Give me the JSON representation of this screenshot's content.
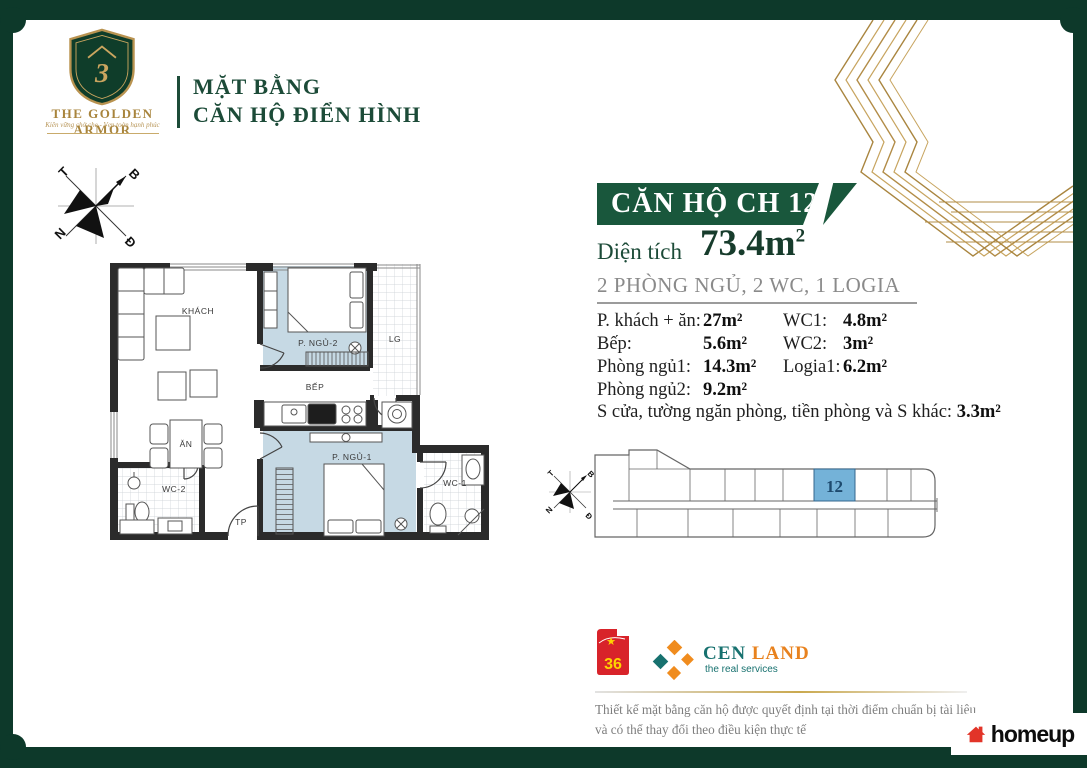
{
  "brand": {
    "name": "THE GOLDEN ARMOR",
    "tagline": "Kiên vững chở che - Vẹn toàn hạnh phúc",
    "title_line1": "MẶT BẰNG",
    "title_line2": "CĂN HỘ ĐIỂN HÌNH"
  },
  "unit": {
    "banner": "CĂN HỘ CH 12",
    "area_label": "Diện tích",
    "area_value": "73.4m",
    "area_sup": "2",
    "config": "2 PHÒNG NGỦ, 2 WC, 1 LOGIA"
  },
  "details": {
    "left": [
      {
        "label": "P. khách + ăn:",
        "value": "27m²"
      },
      {
        "label": "Bếp:",
        "value": "5.6m²"
      },
      {
        "label": "Phòng ngủ1:",
        "value": "14.3m²"
      },
      {
        "label": "Phòng ngủ2:",
        "value": "9.2m²"
      }
    ],
    "right": [
      {
        "label": "WC1:",
        "value": "4.8m²"
      },
      {
        "label": "WC2:",
        "value": "3m²"
      },
      {
        "label": "Logia1:",
        "value": "6.2m²"
      }
    ],
    "other_label": "S cửa, tường ngăn phòng, tiền phòng và S khác:",
    "other_value": "3.3m²"
  },
  "floor_plan": {
    "labels": {
      "khach": "KHÁCH",
      "ngu2": "P. NGỦ-2",
      "lg": "LG",
      "bep": "BẾP",
      "an": "ĂN",
      "wc2": "WC-2",
      "tp": "TP",
      "ngu1": "P. NGỦ-1",
      "wc1": "WC-1"
    },
    "compass": {
      "t": "T",
      "b": "B",
      "n": "N",
      "d": "Đ"
    }
  },
  "key_plan": {
    "unit_number": "12"
  },
  "footer": {
    "flag_number": "36",
    "cen": "CEN",
    "land": "LAND",
    "cen_tagline": "the real services",
    "disclaimer_line1": "Thiết kế mặt bằng căn hộ được quyết định tại thời điểm chuẩn bị tài liệu",
    "disclaimer_line2": "và có thể thay đổi theo điều kiện thực tế",
    "homeup": "homeup"
  },
  "colors": {
    "frame_green": "#0d392a",
    "banner_green": "#19573c",
    "title_green": "#1c4b38",
    "gold": "#b28c47",
    "room_blue": "#c6d9e4",
    "highlight_blue": "#74b2d8",
    "cen_teal": "#17716f",
    "cen_orange": "#e8821e",
    "flag_red": "#d8232a",
    "homeup_red": "#e23428"
  }
}
